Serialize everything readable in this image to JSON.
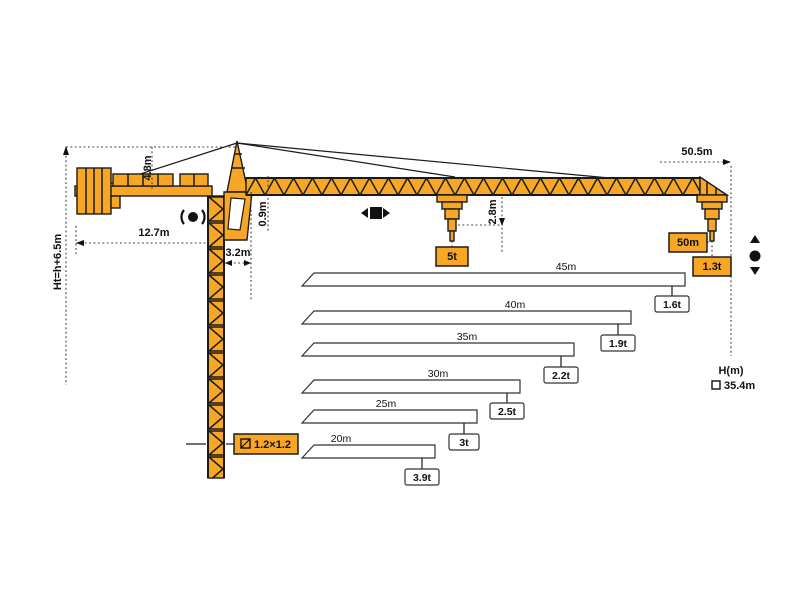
{
  "diagram_title": "Tower crane working range and load diagram",
  "colors": {
    "crane_yellow": "#F7A725",
    "outline": "#1b1b1b",
    "dimension_lines": "#3a3a3a",
    "bar_fill": "#ffffff"
  },
  "labels": {
    "total_height": "Ht=h+6.5m",
    "counter_jib_length": "12.7m",
    "tower_head_height": "4.8m",
    "slew_offset": "3.2m",
    "jib_section_height": "0.9m",
    "hook_clearance": "2.8m",
    "jib_radius": "50.5m",
    "max_load": "5t",
    "tip_radius": "50m",
    "tip_load": "1.3t",
    "hook_height_axis": "H(m)",
    "hook_height_value": "35.4m",
    "mast_section": "1.2×1.2"
  },
  "icons": {
    "trolley_icon": "left-right arrows with black square (trolley travel)",
    "slewing_icon": "black dot with curved arrows (slewing)",
    "hoist_icon": "up/down triangles with black dot (hoisting)",
    "mast_section_icon": "square with diagonal (cross-section)",
    "hook_height_marker_icon": "open square legend marker"
  },
  "chart_data": {
    "type": "bar",
    "title": "Max tip load per jib length",
    "categories": [
      "45m",
      "40m",
      "35m",
      "30m",
      "25m",
      "20m"
    ],
    "lengths_m": [
      45,
      40,
      35,
      30,
      25,
      20
    ],
    "tip_loads_t": [
      1.6,
      1.9,
      2.2,
      2.5,
      3,
      3.9
    ],
    "xlabel": "jib length",
    "ylabel": "tip load",
    "legend_position": "none",
    "grid": false,
    "bars": [
      {
        "length_label": "45m",
        "load_label": "1.6t"
      },
      {
        "length_label": "40m",
        "load_label": "1.9t"
      },
      {
        "length_label": "35m",
        "load_label": "2.2t"
      },
      {
        "length_label": "30m",
        "load_label": "2.5t"
      },
      {
        "length_label": "25m",
        "load_label": "3t"
      },
      {
        "length_label": "20m",
        "load_label": "3.9t"
      }
    ],
    "full_jib": {
      "radius_label": "50.5m",
      "length_label": "50m",
      "tip_load_label": "1.3t",
      "max_load_label": "5t",
      "hook_height_axis": "H(m)",
      "hook_height_value": "35.4m"
    }
  }
}
